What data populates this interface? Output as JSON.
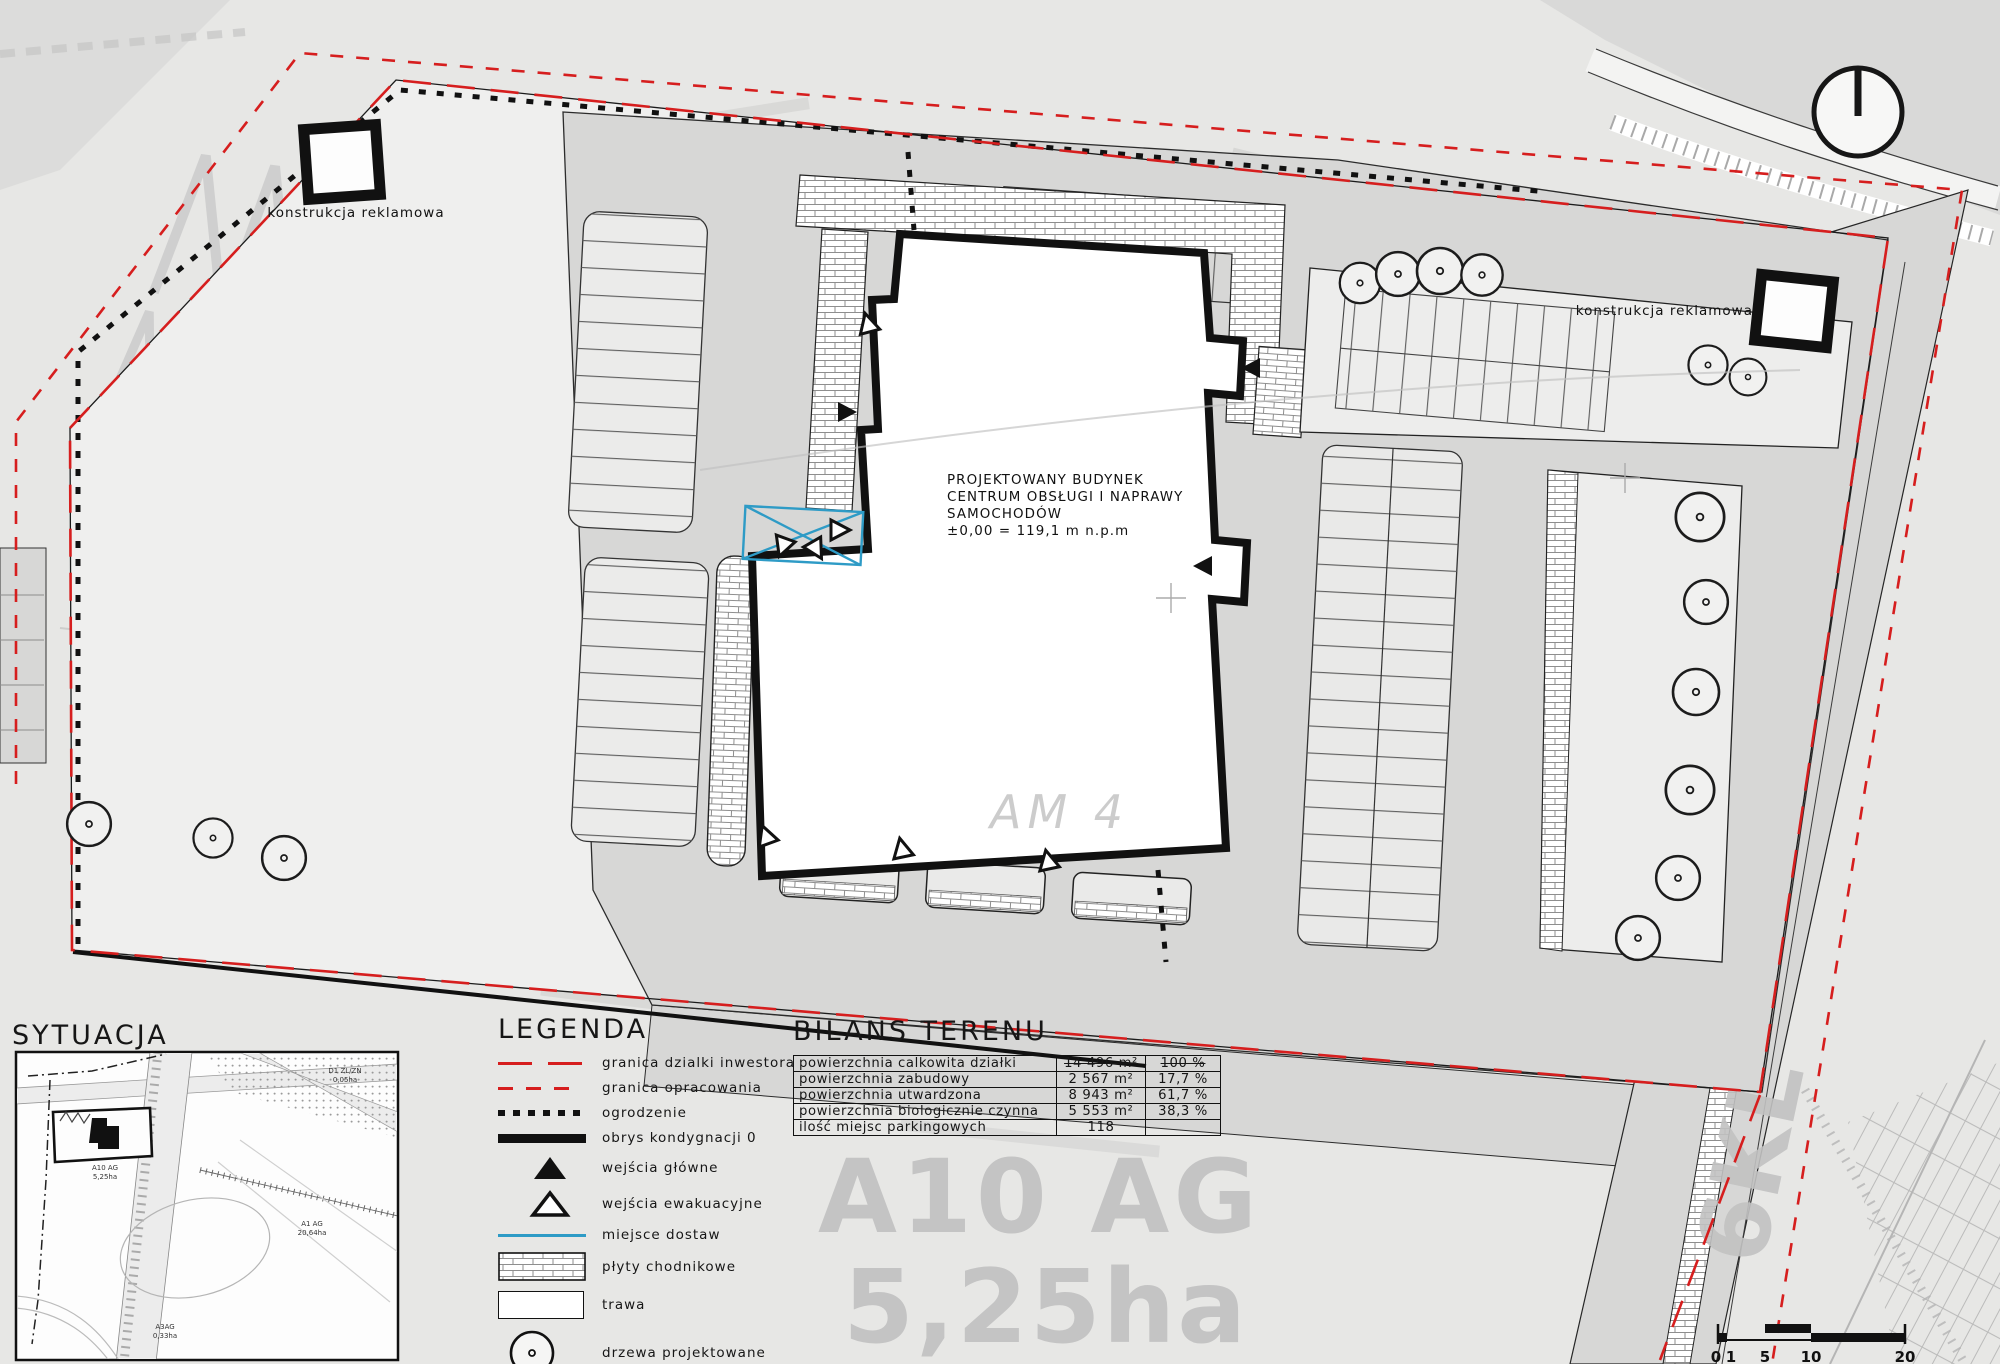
{
  "plan": {
    "building_label": [
      "PROJEKTOWANY BUDYNEK",
      "CENTRUM OBSŁUGI I NAPRAWY",
      "SAMOCHODÓW",
      "±0,00 = 119,1 m n.p.m"
    ],
    "ad_structure_label": "konstrukcja reklamowa",
    "watermark_zone": "A10 AG",
    "watermark_area": "5,25ha",
    "watermark_block": "AM 4",
    "watermark_road": "6KL",
    "watermark_elevation": "119,20"
  },
  "situation": {
    "title": "SYTUACJA",
    "labels": [
      {
        "line1": "A10 AG",
        "line2": "5,25ha"
      },
      {
        "line1": "A1 AG",
        "line2": "20,64ha"
      },
      {
        "line1": "A3AG",
        "line2": "0,33ha"
      },
      {
        "line1": "D1 ZL/ZN",
        "line2": "0,05ha"
      }
    ]
  },
  "legend": {
    "title": "LEGENDA",
    "items": [
      {
        "symbol": "dash-long-red",
        "label": "granica dzialki inwestora"
      },
      {
        "symbol": "dash-short-red",
        "label": "granica opracowania"
      },
      {
        "symbol": "dots-black",
        "label": "ogrodzenie"
      },
      {
        "symbol": "bar-black",
        "label": "obrys kondygnacji 0"
      },
      {
        "symbol": "triangle-filled",
        "label": "wejścia główne"
      },
      {
        "symbol": "triangle-outline",
        "label": "wejścia ewakuacyjne"
      },
      {
        "symbol": "line-blue",
        "label": "miejsce dostaw"
      },
      {
        "symbol": "paving",
        "label": "płyty chodnikowe"
      },
      {
        "symbol": "grass",
        "label": "trawa"
      },
      {
        "symbol": "tree",
        "label": "drzewa projektowane"
      }
    ]
  },
  "balance_table": {
    "title": "BILANS TERENU",
    "rows": [
      {
        "label": "powierzchnia calkowita działki",
        "value": "14 496 m²",
        "percent": "100 %",
        "struck": true
      },
      {
        "label": "powierzchnia zabudowy",
        "value": "2 567 m²",
        "percent": "17,7 %",
        "struck": false
      },
      {
        "label": "powierzchnia utwardzona",
        "value": "8 943 m²",
        "percent": "61,7 %",
        "struck": false
      },
      {
        "label": "powierzchnia biologicznie czynna",
        "value": "5 553 m²",
        "percent": "38,3 %",
        "struck": false
      },
      {
        "label": "ilość miejsc parkingowych",
        "value": "118",
        "percent": "",
        "struck": false
      }
    ]
  },
  "scale_bar": {
    "labels": [
      "0",
      "1",
      "5",
      "10",
      "20"
    ]
  },
  "colors": {
    "boundary_red": "#d61e1e",
    "delivery_blue": "#2e9bc6",
    "paved_gray": "#d7d7d6",
    "watermark_gray": "#c4c4c4",
    "line_black": "#161616"
  }
}
